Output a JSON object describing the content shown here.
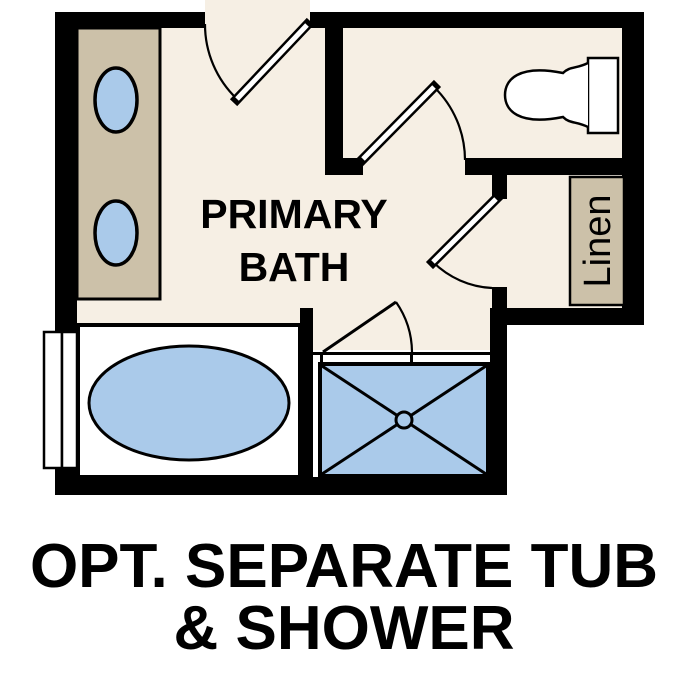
{
  "title": "Primary Bath floor plan option",
  "palette": {
    "bg": "#ffffff",
    "floor": "#f6efe4",
    "wall": "#000000",
    "counter": "#ccc1a9",
    "fixture_blue": "#aacaea",
    "fixture_white": "#ffffff",
    "text": "#000000"
  },
  "labels": {
    "room_line1": "PRIMARY",
    "room_line2": "BATH",
    "linen": "Linen",
    "caption_line1": "OPT. SEPARATE TUB",
    "caption_line2": "& SHOWER"
  }
}
